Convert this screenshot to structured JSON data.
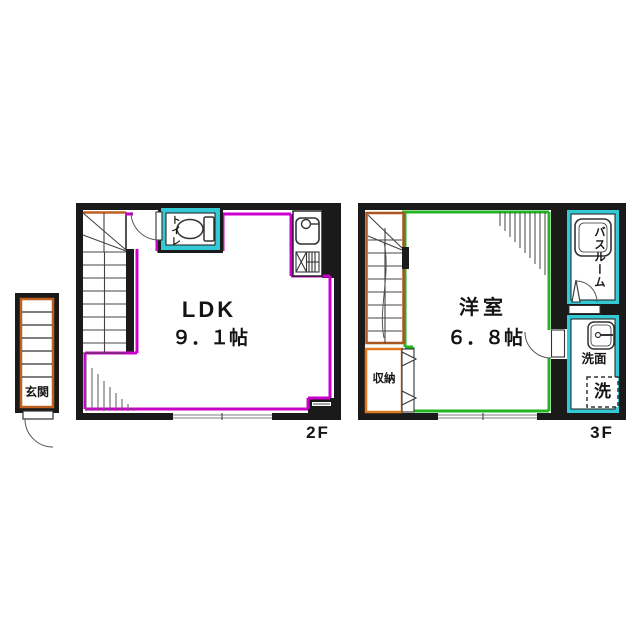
{
  "colors": {
    "wall": "#1a1a1a",
    "floor2_outline": "#cc00cc",
    "floor3_outline": "#22b422",
    "wet_area": "#35c8d5",
    "stair_accent": "#c06020",
    "storage_accent": "#e07820"
  },
  "entrance": {
    "label": "玄関"
  },
  "floor2": {
    "floor_label": "2F",
    "room_name": "LDK",
    "room_size": "９．１帖",
    "toilet_label": "トイレ"
  },
  "floor3": {
    "floor_label": "3F",
    "room_name": "洋室",
    "room_size": "６．８帖",
    "bathroom_label": "バスルーム",
    "washroom_label": "洗面",
    "washer_label": "洗",
    "storage_label": "収納"
  }
}
